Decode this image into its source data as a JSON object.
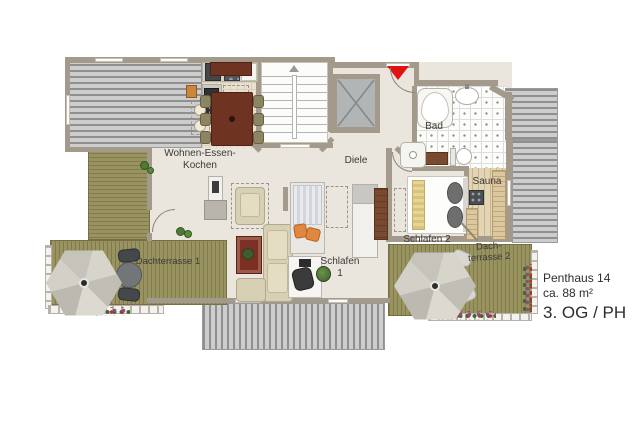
{
  "colors": {
    "wall": "#a39a8c",
    "floor": "#eae6dd",
    "deck": "#99935f",
    "roof_light": "#cdcdcd",
    "roof_dark": "#8f8f8f",
    "accent_red": "#e11212",
    "wood_dark": "#6f3322",
    "rug_red": "#7b2f25",
    "sofa": "#d7d0b5",
    "orange": "#e2873f"
  },
  "rooms": {
    "living": {
      "label_line1": "Wohnen-Essen-",
      "label_line2": "Kochen"
    },
    "hall": {
      "label": "Diele"
    },
    "bath": {
      "label": "Bad"
    },
    "sauna": {
      "label": "Sauna"
    },
    "bedroom2": {
      "label": "Schlafen 2"
    },
    "bedroom1": {
      "label_line1": "Schlafen",
      "label_line2": "1"
    },
    "roof_terrace1": {
      "label": "Dachterrasse 1"
    },
    "roof_terrace2": {
      "label_line1": "Dach-",
      "label_line2": "terrasse 2"
    }
  },
  "info": {
    "title": "Penthaus 14",
    "area": "ca. 88 m²",
    "floor": "3. OG / PH"
  }
}
